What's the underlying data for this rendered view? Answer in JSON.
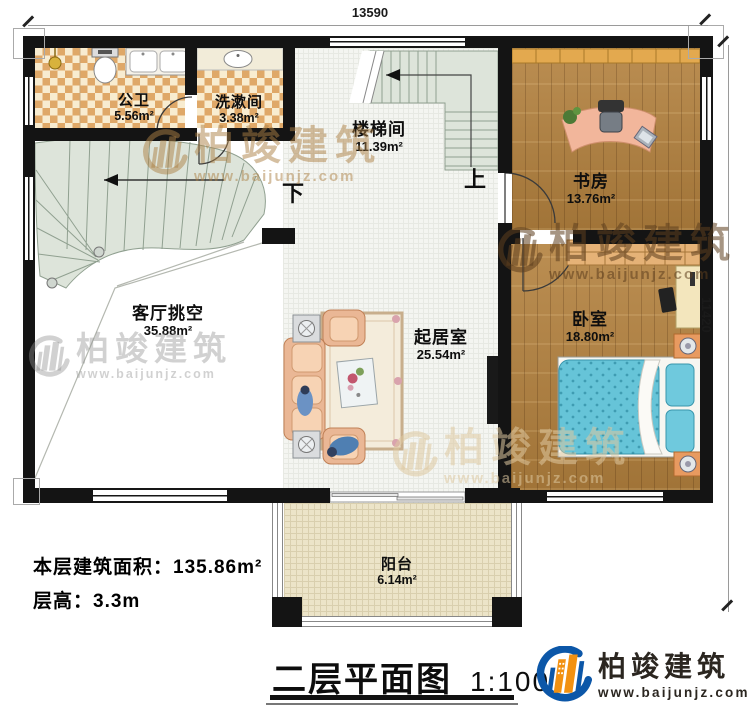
{
  "dimensions": {
    "top": "13590",
    "right": "11420"
  },
  "rooms": {
    "bath": {
      "name": "公卫",
      "area": "5.56m²"
    },
    "wash": {
      "name": "洗漱间",
      "area": "3.38m²"
    },
    "stairwell": {
      "name": "楼梯间",
      "area": "11.39m²"
    },
    "study": {
      "name": "书房",
      "area": "13.76m²"
    },
    "void": {
      "name": "客厅挑空",
      "area": "35.88m²"
    },
    "living": {
      "name": "起居室",
      "area": "25.54m²"
    },
    "bedroom": {
      "name": "卧室",
      "area": "18.80m²"
    },
    "balcony": {
      "name": "阳台",
      "area": "6.14m²"
    }
  },
  "stairs": {
    "down": "下",
    "up": "上"
  },
  "info": {
    "area_line": "本层建筑面积：135.86m²",
    "height_line": "层高：3.3m"
  },
  "title": {
    "text": "二层平面图",
    "scale": "1:100"
  },
  "logo": {
    "brand": "柏竣建筑",
    "url": "www.baijunjz.com"
  },
  "watermark": {
    "brand": "柏竣建筑",
    "url": "www.baijunjz.com"
  },
  "colors": {
    "wall": "#141414",
    "wood_floor": "#b3813e",
    "stair_tread": "#dde4da",
    "tile_accent": "#dfa868",
    "bed": "#66c4d8",
    "logo_blue": "#0c57a8",
    "logo_orange": "#f29111"
  }
}
